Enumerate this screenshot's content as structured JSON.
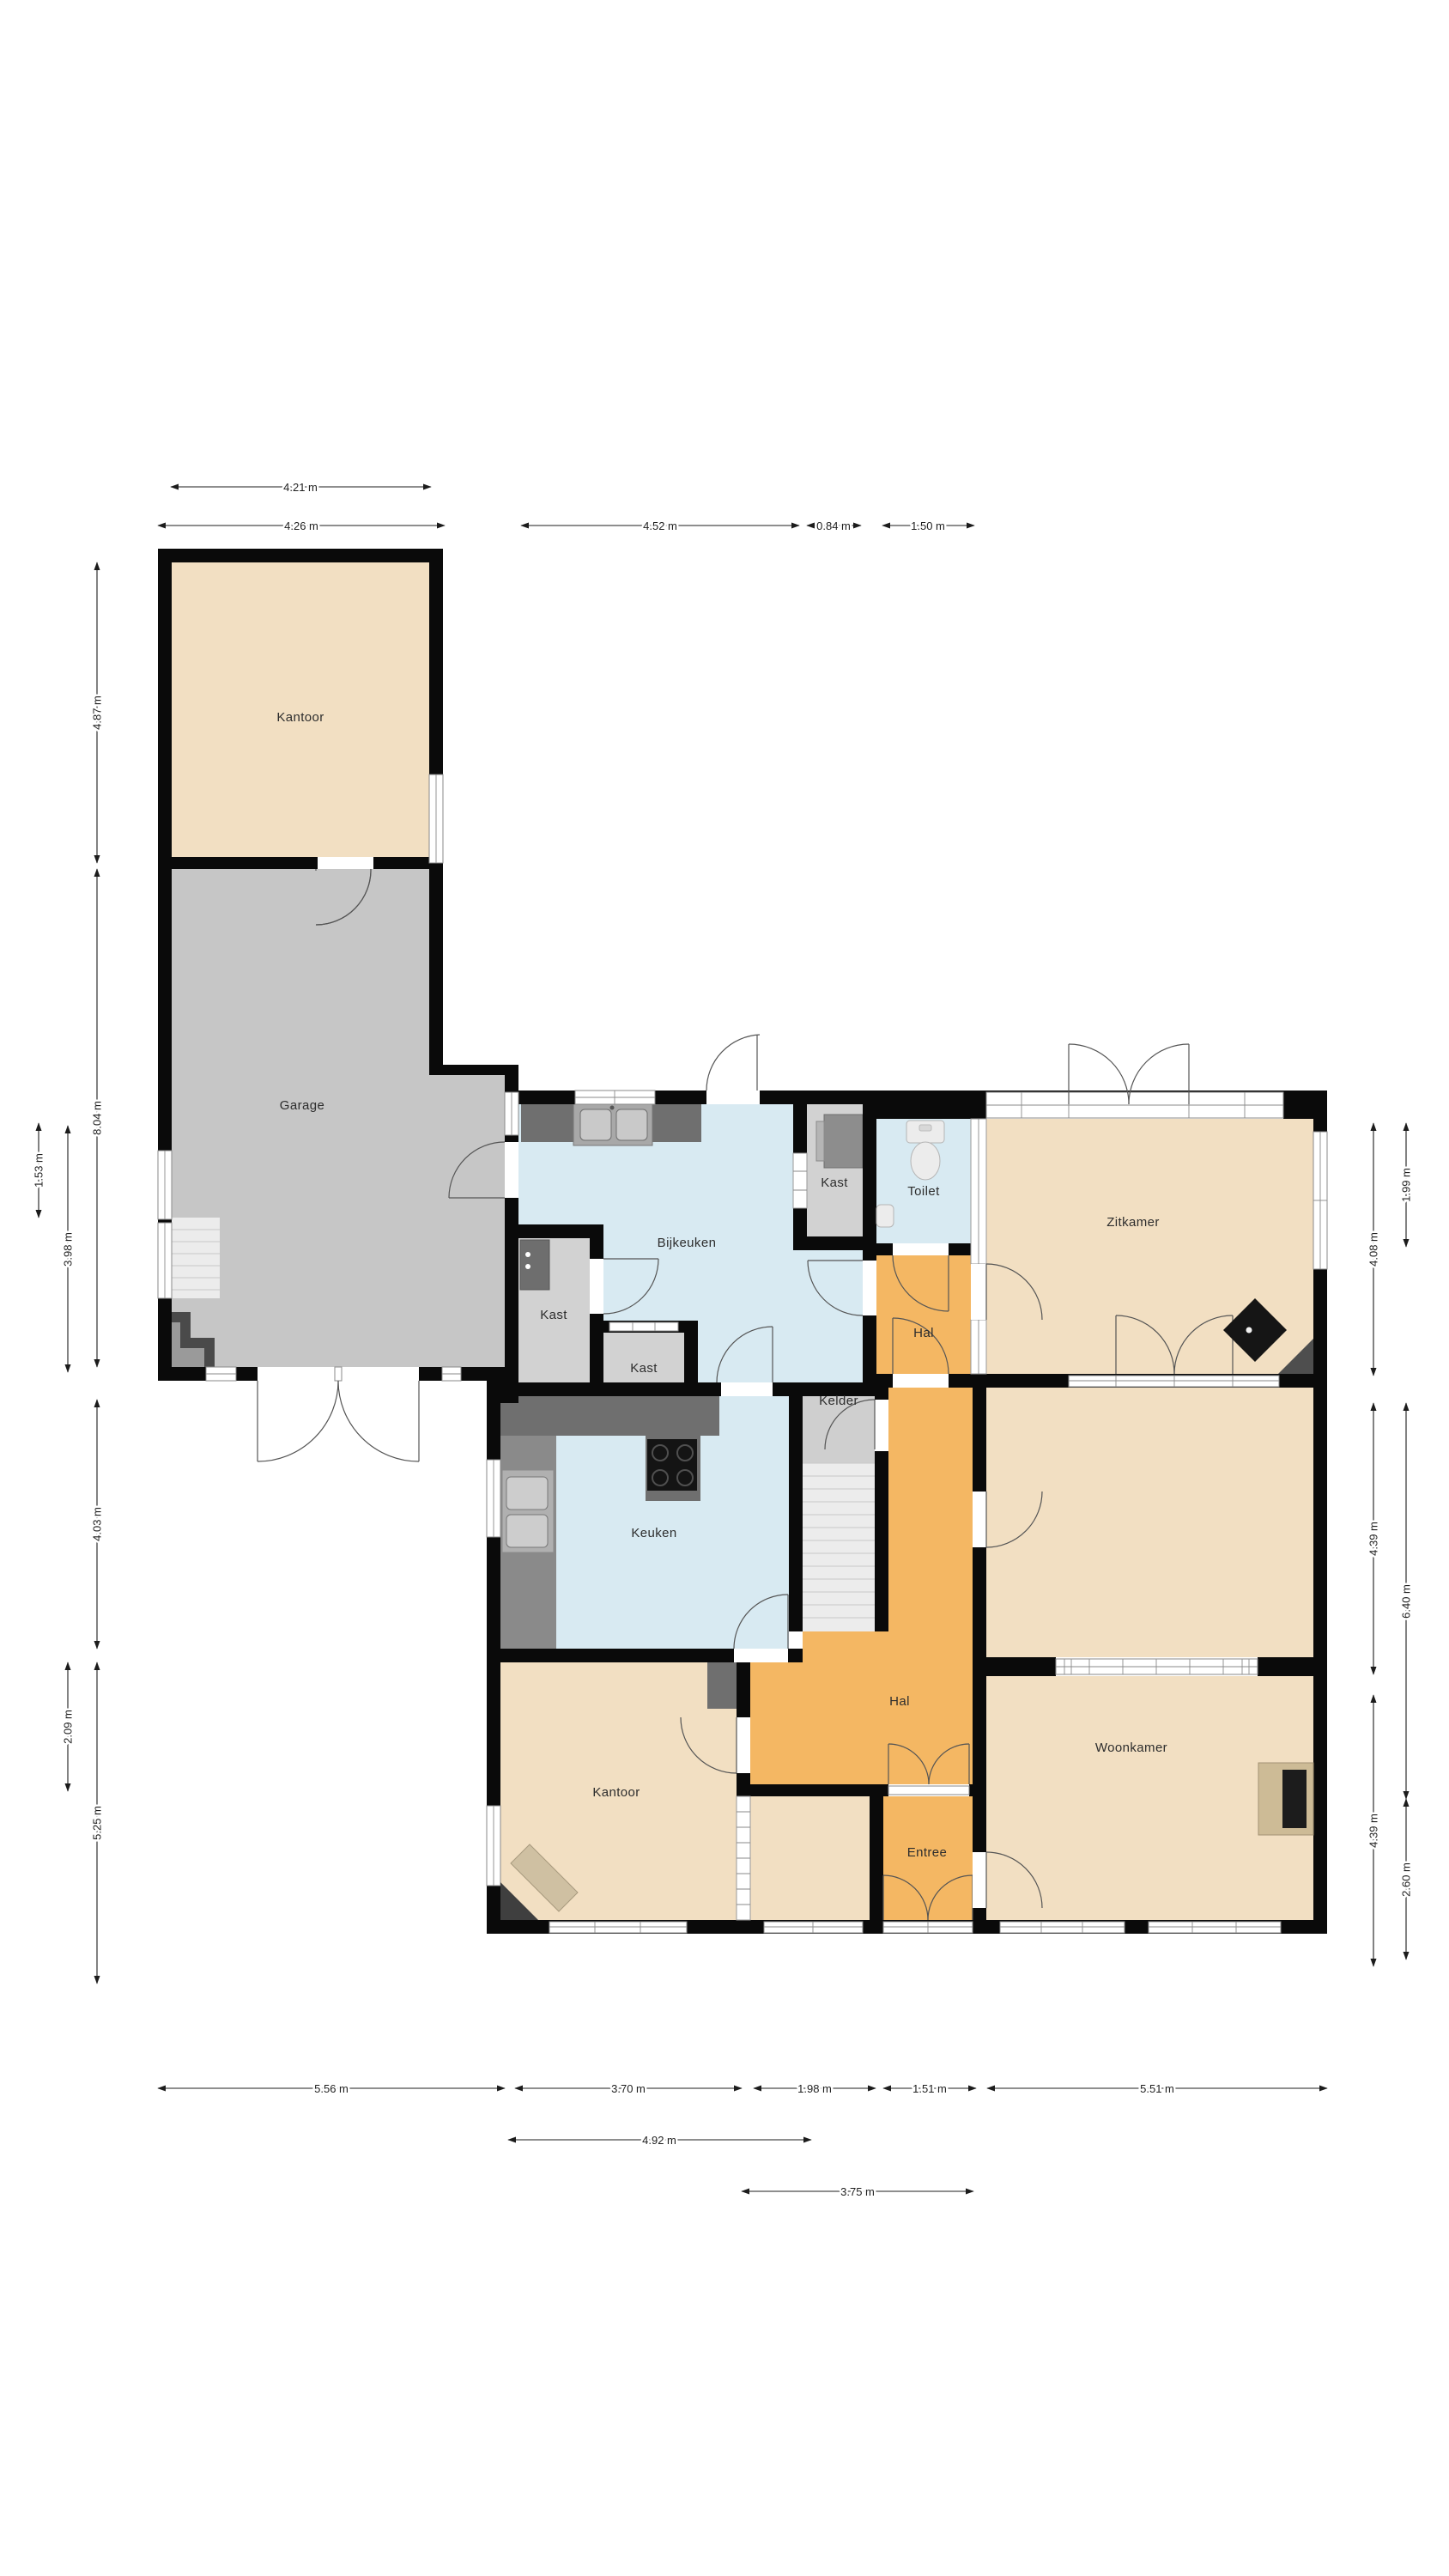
{
  "meta": {
    "type": "floorplan",
    "unit": "m",
    "background": "#ffffff"
  },
  "rooms": {
    "kantoor_top": "Kantoor",
    "garage": "Garage",
    "bijkeuken": "Bijkeuken",
    "kast_upper": "Kast",
    "toilet": "Toilet",
    "zitkamer": "Zitkamer",
    "hal_upper": "Hal",
    "kast_left": "Kast",
    "kast_small": "Kast",
    "kelder": "Kelder",
    "keuken": "Keuken",
    "hal": "Hal",
    "kantoor": "Kantoor",
    "entree": "Entree",
    "woonkamer": "Woonkamer"
  },
  "dimensions": {
    "top": {
      "t1": "4.21 m",
      "t2": "4.26 m",
      "t3": "4.52 m",
      "t4": "0.84 m",
      "t5": "1.50 m"
    },
    "left": {
      "l1": "4.87 m",
      "l2": "8.04 m",
      "l3": "4.03 m",
      "l4": "5.25 m",
      "l5": "3.98 m",
      "l6": "2.09 m",
      "l7": "1.53 m"
    },
    "right": {
      "r1": "4.08 m",
      "r2": "4.39 m",
      "r3": "4.39 m",
      "r4": "1.99 m",
      "r5": "6.40 m",
      "r6": "2.60 m"
    },
    "bottom": {
      "b1": "5.56 m",
      "b2": "3.70 m",
      "b3": "1.98 m",
      "b4": "1.51 m",
      "b5": "5.51 m",
      "b6": "4.92 m",
      "b7": "3.75 m"
    }
  },
  "colors": {
    "room_beige": "#f2dfc2",
    "room_blue": "#d8eaf2",
    "room_orange": "#f4b763",
    "garage_gray": "#c6c6c6",
    "closet_gray": "#d2d2d2",
    "kelder_gray": "#cfcfcf",
    "wall_black": "#0a0a0a",
    "counter_dark": "#6f6f6f",
    "counter_mid": "#8a8a8a",
    "sink_gray": "#c6c6c6",
    "stairs_light": "#ececec",
    "fireplace_tan": "#cdbb96",
    "stove_black": "#141414"
  }
}
